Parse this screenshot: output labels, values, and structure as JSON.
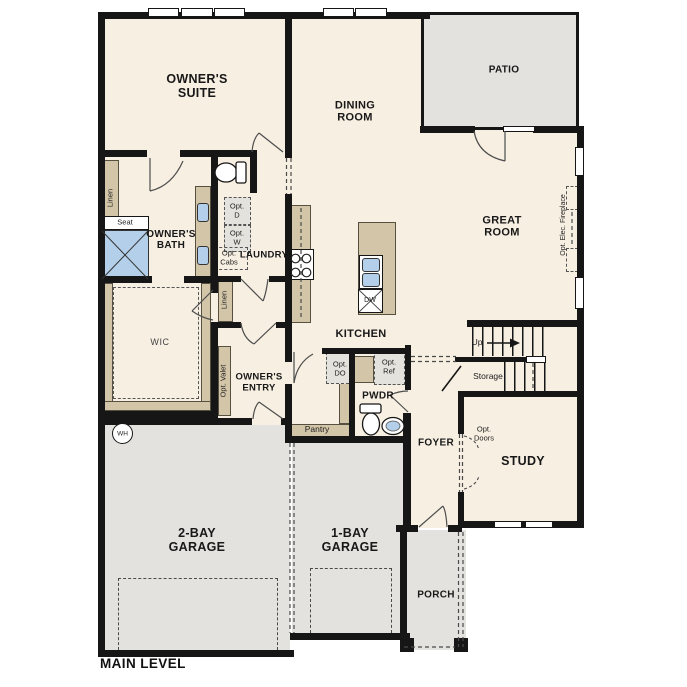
{
  "colors": {
    "floor": "#f7efe2",
    "hardscape": "#e3e2df",
    "counter": "#d3c5a8",
    "fixture_blue": "#b3cfe9",
    "wall": "#161616"
  },
  "plan_title": "MAIN LEVEL",
  "rooms": {
    "owners_suite": "OWNER'S SUITE",
    "dining_room": "DINING ROOM",
    "patio": "PATIO",
    "great_room": "GREAT ROOM",
    "owners_bath": "OWNER'S BATH",
    "laundry": "LAUNDRY",
    "wic": "WIC",
    "owners_entry": "OWNER'S ENTRY",
    "kitchen": "KITCHEN",
    "pantry": "Pantry",
    "pwdr": "PWDR",
    "foyer": "FOYER",
    "study": "STUDY",
    "storage": "Storage",
    "garage_2bay": "2-BAY GARAGE",
    "garage_1bay": "1-BAY GARAGE",
    "porch": "PORCH"
  },
  "annotations": {
    "up": "Up",
    "wh": "WH",
    "seat": "Seat",
    "linen_bath": "Linen",
    "linen_hall": "Linen",
    "opt_dryer": "Opt. D",
    "opt_washer": "Opt. W",
    "opt_cabs": "Opt. Cabs",
    "opt_valet": "Opt. Valet",
    "opt_double_oven": "Opt. DO",
    "opt_refrigerator": "Opt. Ref",
    "opt_doors": "Opt. Doors",
    "opt_elec_fireplace": "Opt. Elec. Fireplace",
    "dishwasher": "DW"
  }
}
